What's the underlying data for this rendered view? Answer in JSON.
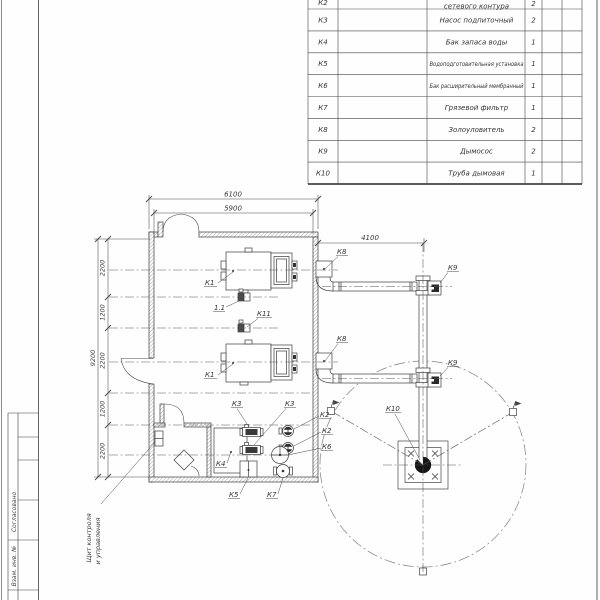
{
  "sheet": {
    "background": "#fefefe",
    "line_color": "#3c3c3c",
    "centerline_color": "#555555",
    "circle_color": "#808080"
  },
  "spec_table": {
    "rows": [
      {
        "pos": "К2",
        "name": "сетевого контура",
        "qty": "2"
      },
      {
        "pos": "К3",
        "name": "Насос подпиточный",
        "qty": "2"
      },
      {
        "pos": "К4",
        "name": "Бак запаса воды",
        "qty": "1"
      },
      {
        "pos": "К5",
        "name": "Водоподготовительная установка",
        "qty": "1"
      },
      {
        "pos": "К6",
        "name": "Бак расширительный мембранный",
        "qty": "1"
      },
      {
        "pos": "К7",
        "name": "Грязевой фильтр",
        "qty": "1"
      },
      {
        "pos": "К8",
        "name": "Золоуловитель",
        "qty": "2"
      },
      {
        "pos": "К9",
        "name": "Дымосос",
        "qty": "2"
      },
      {
        "pos": "К10",
        "name": "Труба дымовая",
        "qty": "1"
      }
    ]
  },
  "dimensions": {
    "top_outer": "6100",
    "top_inner": "5900",
    "flue": "4100",
    "left_total": "9200",
    "left_segments": [
      "2200",
      "1200",
      "2200",
      "1200",
      "2200"
    ]
  },
  "labels": {
    "k1a": "К1",
    "k1b": "К1",
    "v11": "1.1",
    "k11": "К11",
    "k8a": "К8",
    "k8b": "К8",
    "k9a": "К9",
    "k9b": "К9",
    "k10": "К10",
    "k3a": "К3",
    "k3b": "К3",
    "k2a": "К2",
    "k2b": "К2",
    "k4": "К4",
    "k5": "К5",
    "k6": "К6",
    "k7": "К7"
  },
  "note": {
    "line1": "Щит контроля",
    "line2": "и управления"
  },
  "stamp": {
    "agreed": "Согласовано",
    "vzam": "Взам. инв. №"
  }
}
